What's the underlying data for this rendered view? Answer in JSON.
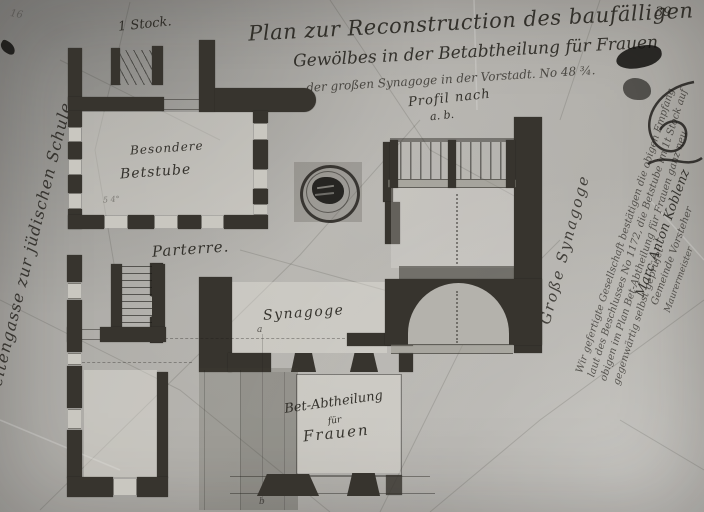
{
  "document": {
    "archive_number": "39",
    "corner_mark": "16",
    "title_line1": "Plan zur Reconstruction des baufälligen",
    "title_line2": "Gewölbes in der Betabtheilung für Frauen",
    "title_line3": "der großen Synagoge in der Vorstadt.  No 48 ¾."
  },
  "plan_labels": {
    "floor": "1 Stock.",
    "street": "Seitengasse zur jüdischen Schule",
    "prayer_room_line1": "Besondere",
    "prayer_room_line2": "Betstube",
    "scale_marks": "5   4°",
    "ground_floor": "Parterre.",
    "synagogue_hall": "Synagoge",
    "womens_line1": "Bet-Abtheilung",
    "womens_line2": "für",
    "womens_line3": "Frauen",
    "section_title_line1": "Profil nach",
    "section_title_line2": "a. b.",
    "great_synagogue": "Große Synagoge",
    "section_point_a": "a",
    "section_point_b": "b"
  },
  "annotation": {
    "note_lines": [
      "Wir gefertigte Gesellschaft bestätigen die obigen Empfang",
      "laut des Beschlusses No 1172, die Betstube im 1t Stock auf",
      "obigen im Plan Bet-Abtheilung für Frauen ganz neu",
      "gegenwärtig selbst geprüfet"
    ],
    "signature_lines": [
      "Marc Anton Koblenz",
      "Gemeinde Vorsteher",
      "Maurermeister"
    ]
  }
}
